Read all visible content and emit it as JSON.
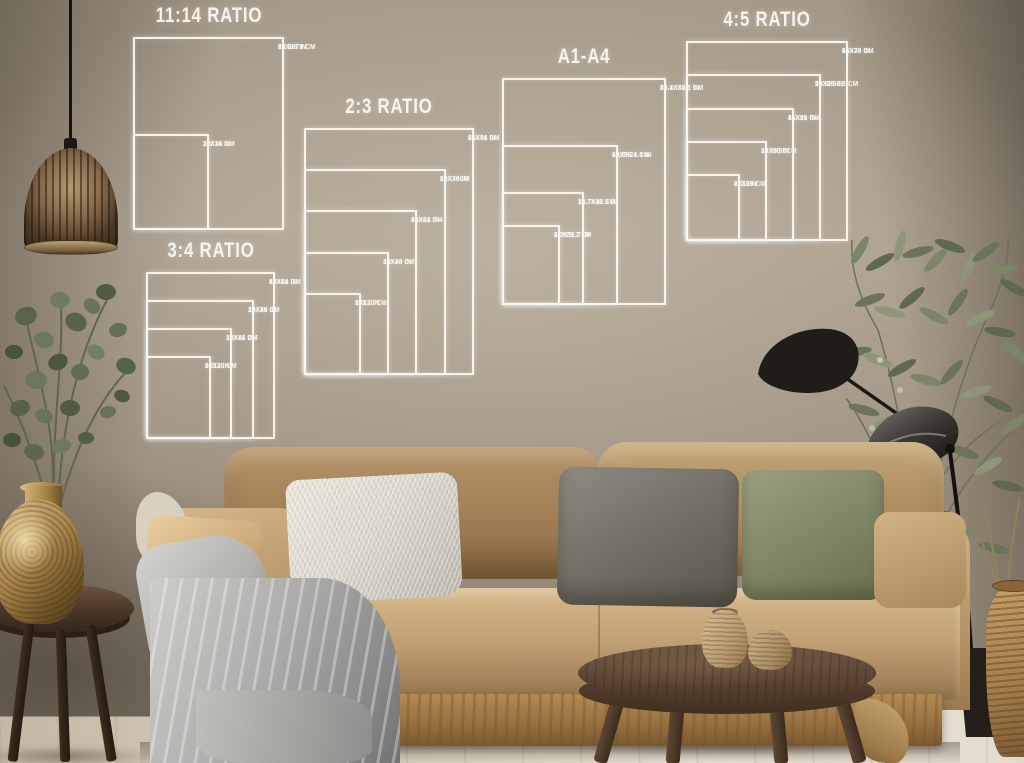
{
  "overlay": {
    "line_color": "#f7f4ee",
    "text_color": "#f7f4ee"
  },
  "size_groups": [
    {
      "id": "ratio-11-14",
      "title": "11:14 RATIO",
      "box": {
        "left": 133,
        "top": 37,
        "width": 151,
        "height": 193
      },
      "sizes": [
        {
          "inches": "22X28 IN",
          "cm": "55.9X71 CM",
          "w_in": 22,
          "h_in": 28
        },
        {
          "inches": "11X14 IN",
          "cm": "28X36 CM",
          "w_in": 11,
          "h_in": 14
        }
      ]
    },
    {
      "id": "ratio-2-3",
      "title": "2:3 RATIO",
      "box": {
        "left": 304,
        "top": 128,
        "width": 170,
        "height": 247
      },
      "sizes": [
        {
          "inches": "24X36 IN",
          "cm": "61X91 CM",
          "w_in": 24,
          "h_in": 36
        },
        {
          "inches": "20X30 IN",
          "cm": "51X76CM",
          "w_in": 20,
          "h_in": 30
        },
        {
          "inches": "16X24 IN",
          "cm": "41X61 CM",
          "w_in": 16,
          "h_in": 24
        },
        {
          "inches": "12X18 IN",
          "cm": "30X46 CM",
          "w_in": 12,
          "h_in": 18
        },
        {
          "inches": "8X12 IN",
          "cm": "20X30 CM",
          "w_in": 8,
          "h_in": 12
        }
      ]
    },
    {
      "id": "ratio-3-4",
      "title": "3:4 RATIO",
      "box": {
        "left": 146,
        "top": 272,
        "width": 129,
        "height": 167
      },
      "sizes": [
        {
          "inches": "18X24 IN",
          "cm": "46X61 CM",
          "w_in": 18,
          "h_in": 24
        },
        {
          "inches": "15X20 IN",
          "cm": "38X51 CM",
          "w_in": 15,
          "h_in": 20
        },
        {
          "inches": "12X16 IN",
          "cm": "30X41 CM",
          "w_in": 12,
          "h_in": 16
        },
        {
          "inches": "9X12 IN",
          "cm": "23X30 CM",
          "w_in": 9,
          "h_in": 12
        }
      ]
    },
    {
      "id": "a1-a4",
      "title": "A1-A4",
      "box": {
        "left": 502,
        "top": 78,
        "width": 164,
        "height": 227
      },
      "sizes": [
        {
          "inches": "23.4X33.1 IN",
          "cm": "59.1X84.1 CM",
          "w_in": 23.4,
          "h_in": 33.1
        },
        {
          "inches": "16.5X23.4 IN",
          "cm": "42X59.4 CM",
          "w_in": 16.5,
          "h_in": 23.4
        },
        {
          "inches": "11.7X16.5 IN",
          "cm": "29.7X42 CM",
          "w_in": 11.7,
          "h_in": 16.5
        },
        {
          "inches": "8.3X11.7 IN",
          "cm": "21X29.7 CM",
          "w_in": 8.3,
          "h_in": 11.7
        }
      ]
    },
    {
      "id": "ratio-4-5",
      "title": "4:5 RATIO",
      "box": {
        "left": 686,
        "top": 41,
        "width": 162,
        "height": 200
      },
      "sizes": [
        {
          "inches": "24X30 IN",
          "cm": "61X76 CM",
          "w_in": 24,
          "h_in": 30
        },
        {
          "inches": "20X25 IN",
          "cm": "50.8X63.5 CM",
          "w_in": 20,
          "h_in": 25
        },
        {
          "inches": "16X20 IN",
          "cm": "41X51 CM",
          "w_in": 16,
          "h_in": 20
        },
        {
          "inches": "12X15 IN",
          "cm": "30.5X38CM",
          "w_in": 12,
          "h_in": 15
        },
        {
          "inches": "8X10IN",
          "cm": "20X25 CM",
          "w_in": 8,
          "h_in": 10
        }
      ]
    }
  ],
  "scene_colors": {
    "wall": "#ac9f8f",
    "sofa_camel": "#b79467",
    "floor": "#e6dfd2",
    "gold_vase": "#ab874d",
    "lamp_black": "#201c17",
    "plant_green": "#6b7458"
  }
}
